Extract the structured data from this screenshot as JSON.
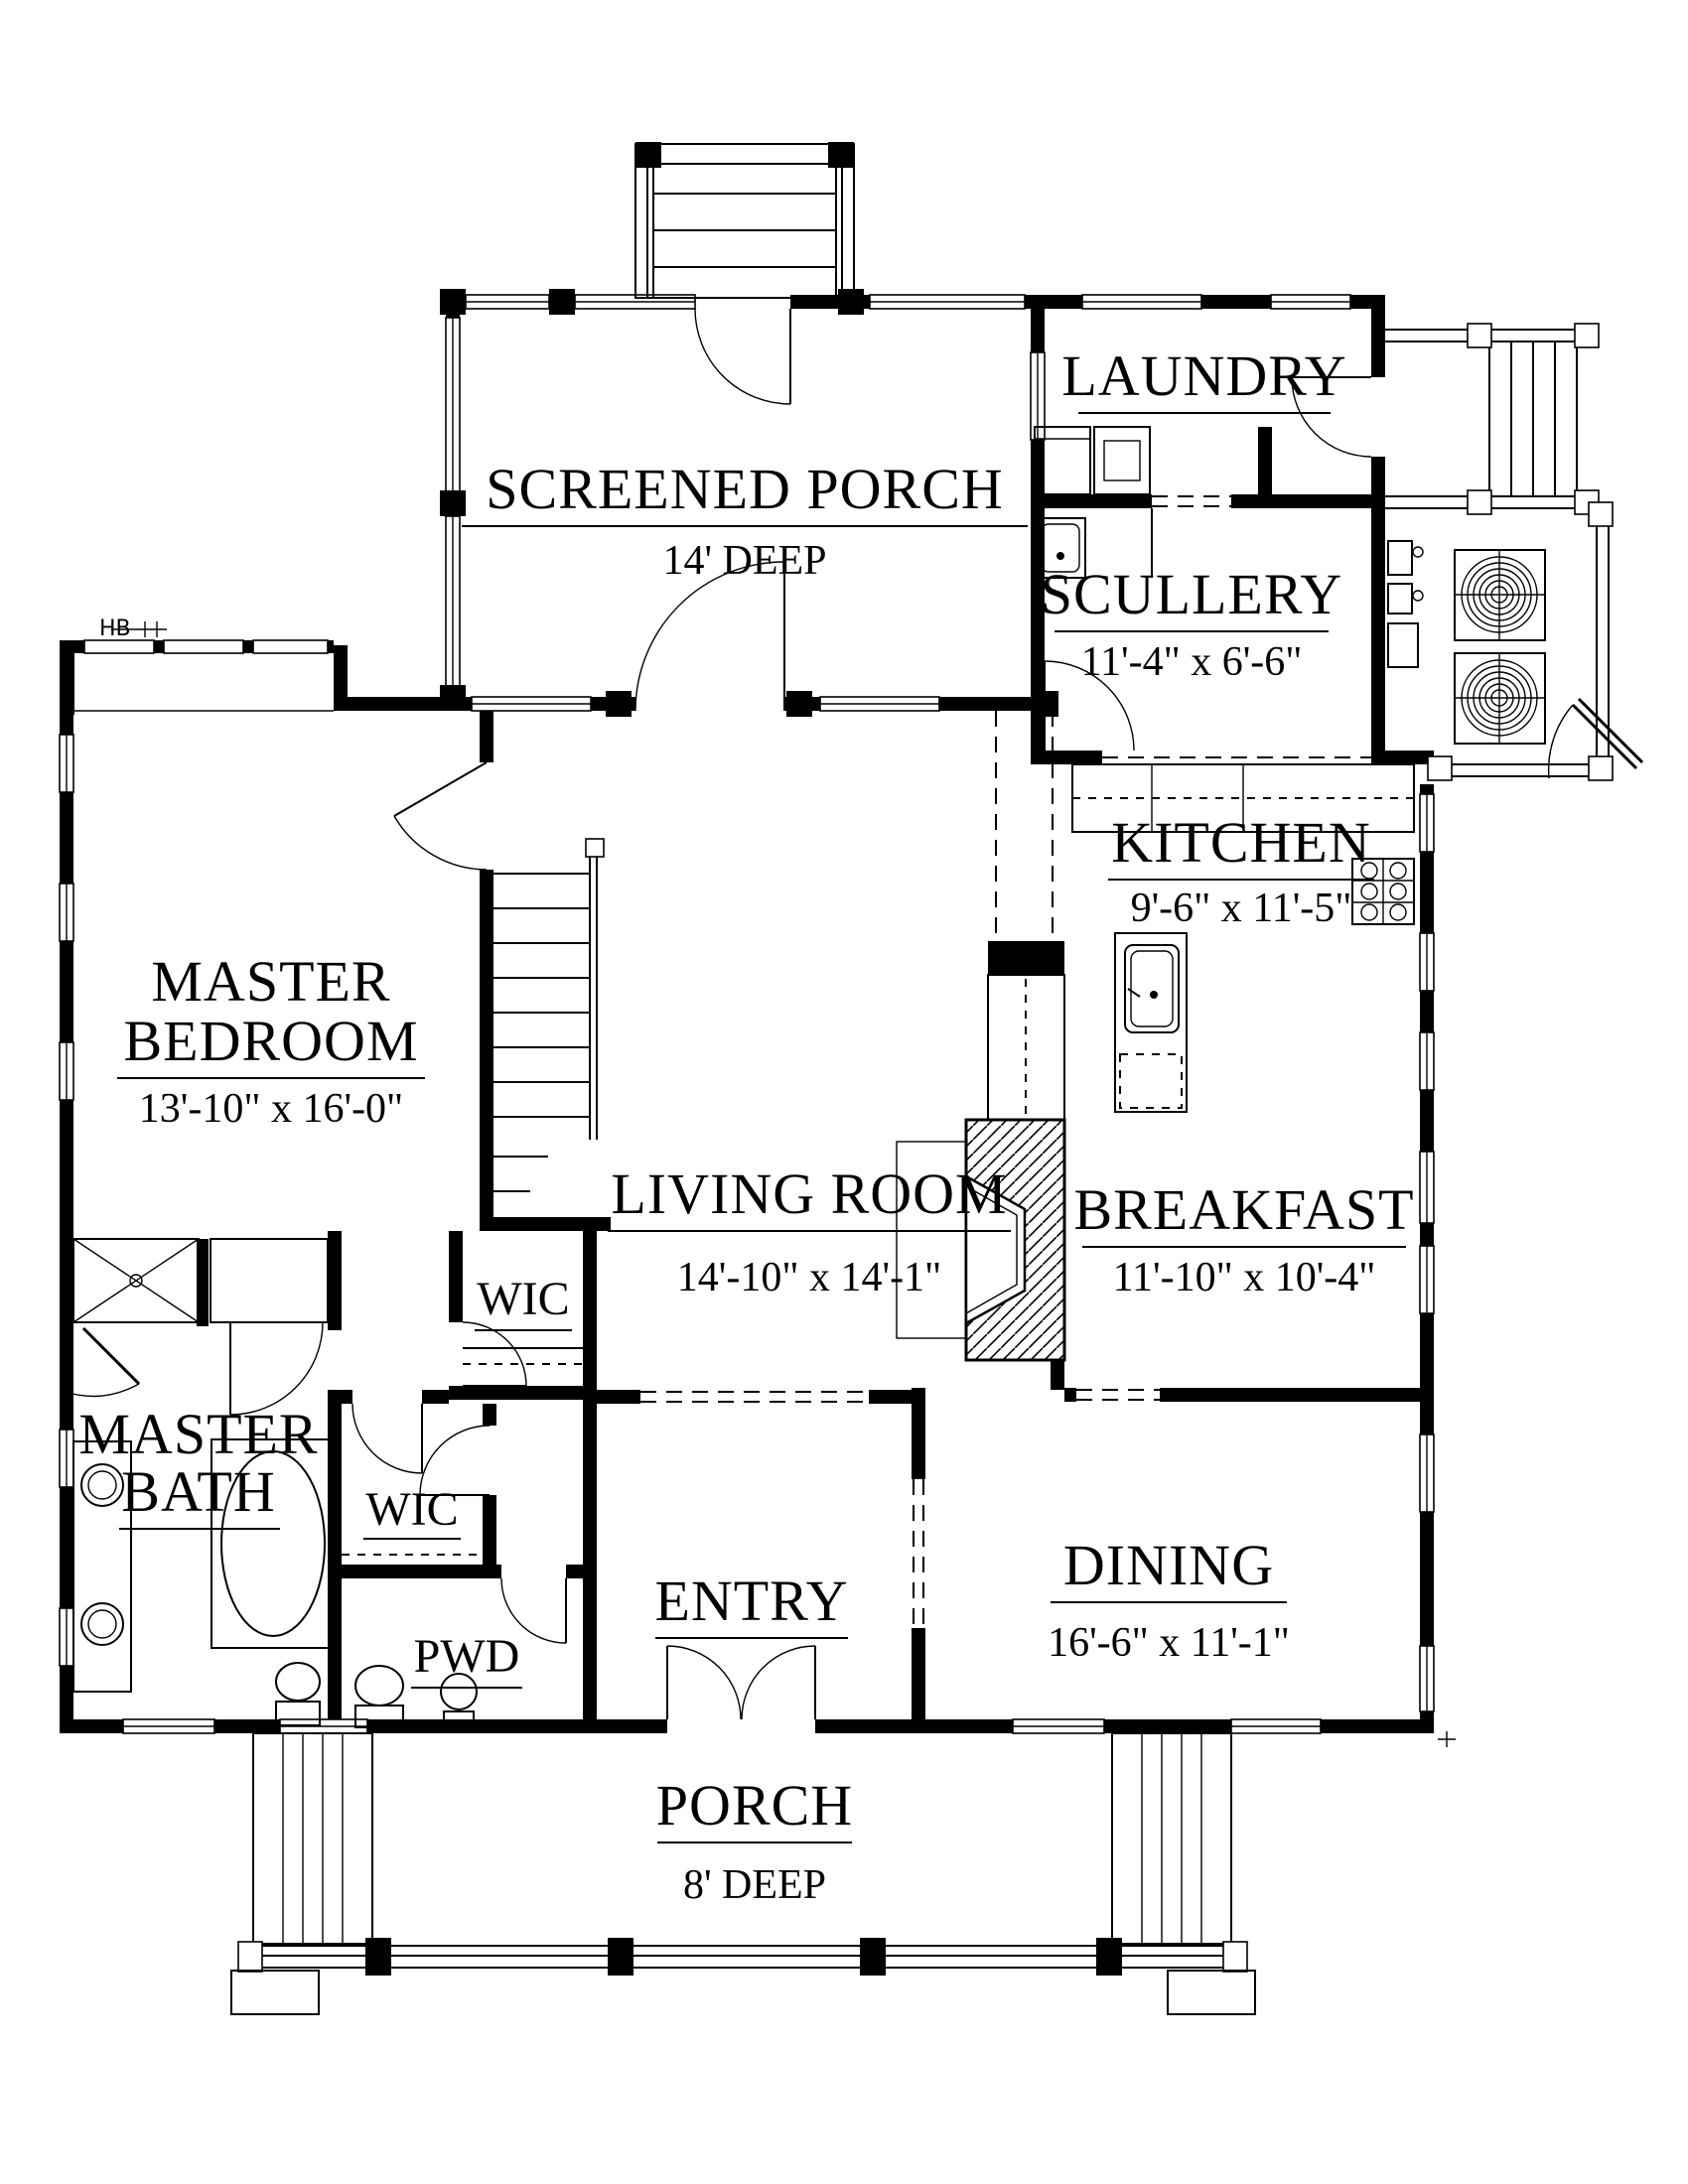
{
  "plan": {
    "rooms": {
      "screened_porch": {
        "label": "SCREENED PORCH",
        "dims": "14' DEEP"
      },
      "laundry": {
        "label": "LAUNDRY"
      },
      "scullery": {
        "label": "SCULLERY",
        "dims": "11'-4\" x 6'-6\""
      },
      "kitchen": {
        "label": "KITCHEN",
        "dims": "9'-6\" x 11'-5\""
      },
      "master_bedroom": {
        "label_line1": "MASTER",
        "label_line2": "BEDROOM",
        "dims": "13'-10\" x 16'-0\""
      },
      "living_room": {
        "label": "LIVING ROOM",
        "dims": "14'-10\" x 14'-1\""
      },
      "breakfast": {
        "label": "BREAKFAST",
        "dims": "11'-10\" x 10'-4\""
      },
      "master_bath": {
        "label_line1": "MASTER",
        "label_line2": "BATH"
      },
      "wic_hall": {
        "label": "WIC"
      },
      "wic_master": {
        "label": "WIC"
      },
      "pwd": {
        "label": "PWD"
      },
      "entry": {
        "label": "ENTRY"
      },
      "dining": {
        "label": "DINING",
        "dims": "16'-6\" x 11'-1\""
      },
      "porch": {
        "label": "PORCH",
        "dims": "8' DEEP"
      }
    },
    "annotations": {
      "hose_bib": "HB"
    },
    "colors": {
      "line": "#000000",
      "background": "#ffffff"
    }
  }
}
